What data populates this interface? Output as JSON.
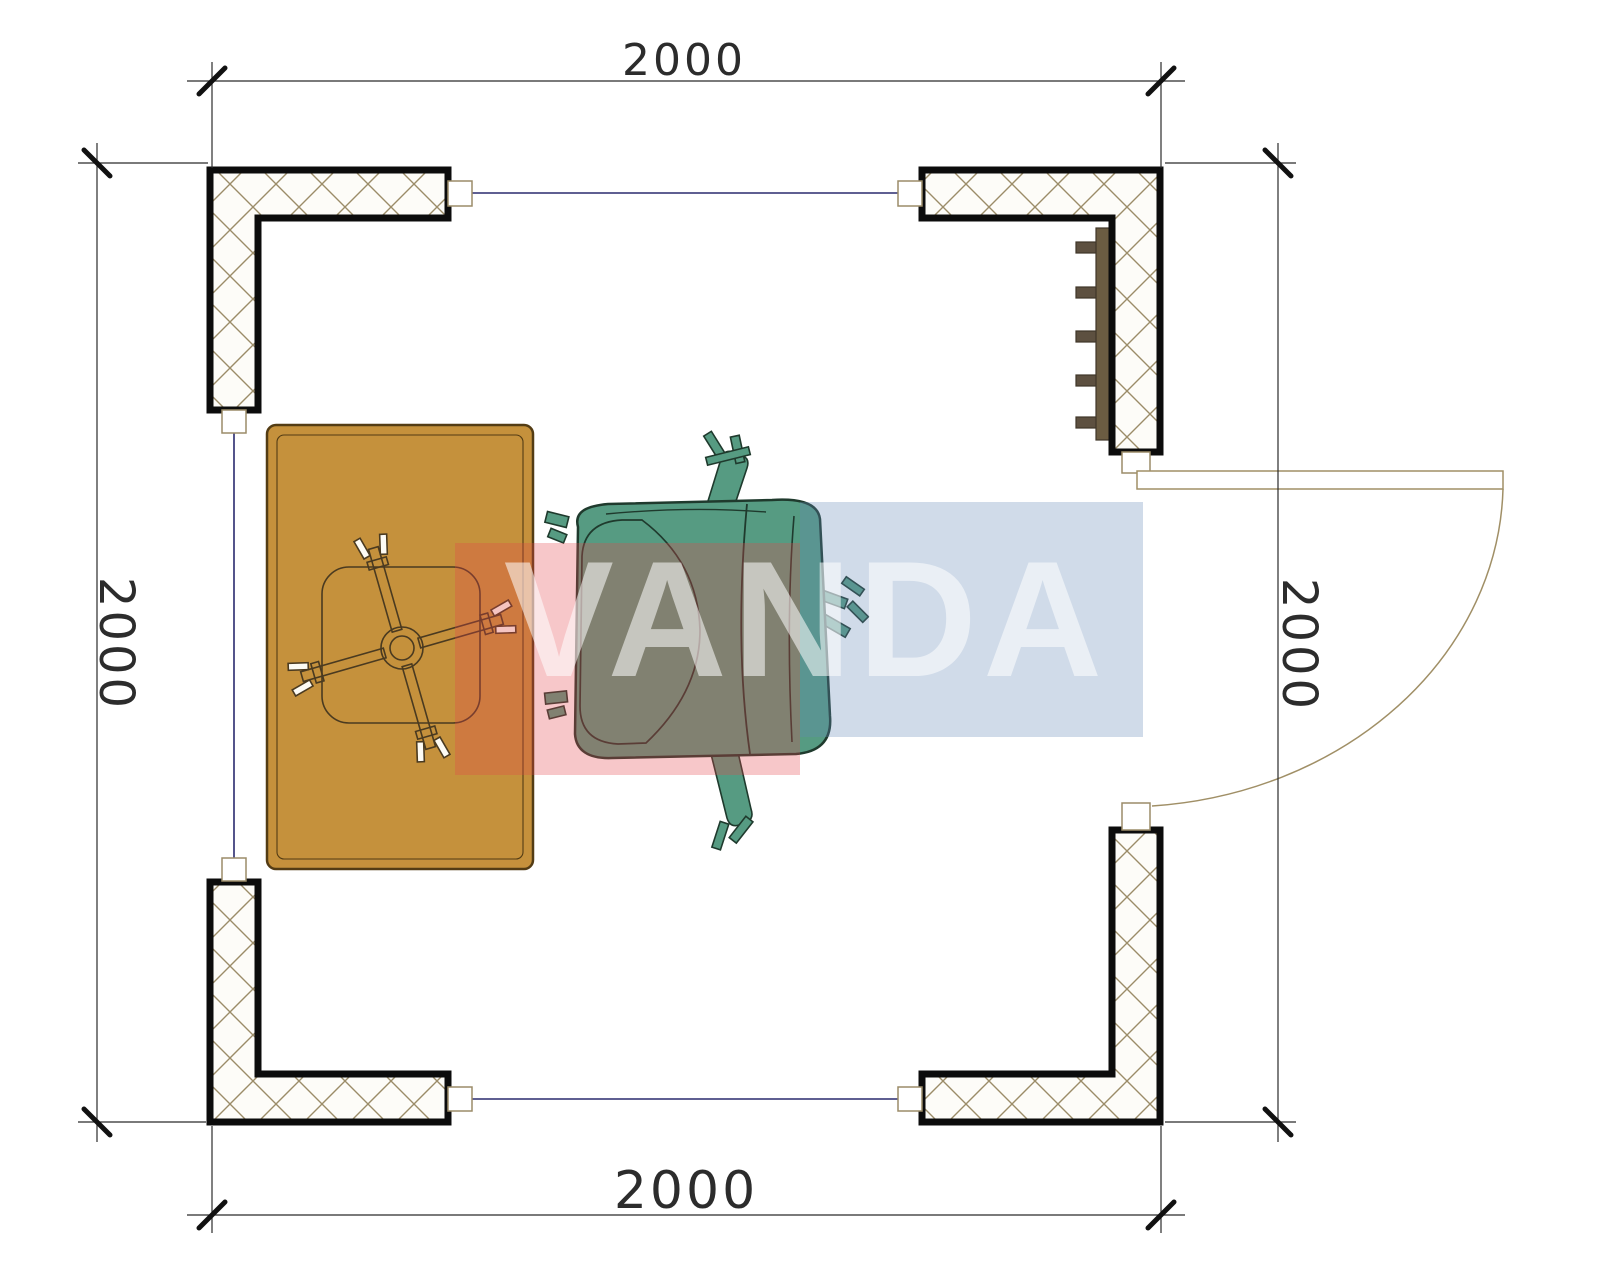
{
  "dimensions": {
    "top": "2000",
    "bottom": "2000",
    "left": "2000",
    "right": "2000"
  },
  "watermark": {
    "text": "VANDA",
    "red_block_color": "rgba(228,68,75,0.30)",
    "blue_block_color": "rgba(98,135,182,0.30)",
    "text_color": "rgba(255,255,255,0.55)"
  },
  "colors": {
    "background": "#ffffff",
    "wall_outline": "#0c0c0c",
    "hatch_line": "#9b8c68",
    "panel_line": "#2a2a6e",
    "connector_line": "#9b8c68",
    "door_line": "#a08f66",
    "dim_line": "#2b2b2b",
    "dim_tick": "#111111",
    "dim_text": "#2c2c2c",
    "desk_fill": "#c5913c",
    "desk_outline": "#533c14",
    "stool_line": "#4a3a20",
    "chair_fill": "#569b82",
    "chair_outline": "#1f3a2d",
    "shelf_fill": "#6b5c42",
    "shelf_tab_fill": "#5d5040",
    "shelf_outline": "#3f3628"
  }
}
